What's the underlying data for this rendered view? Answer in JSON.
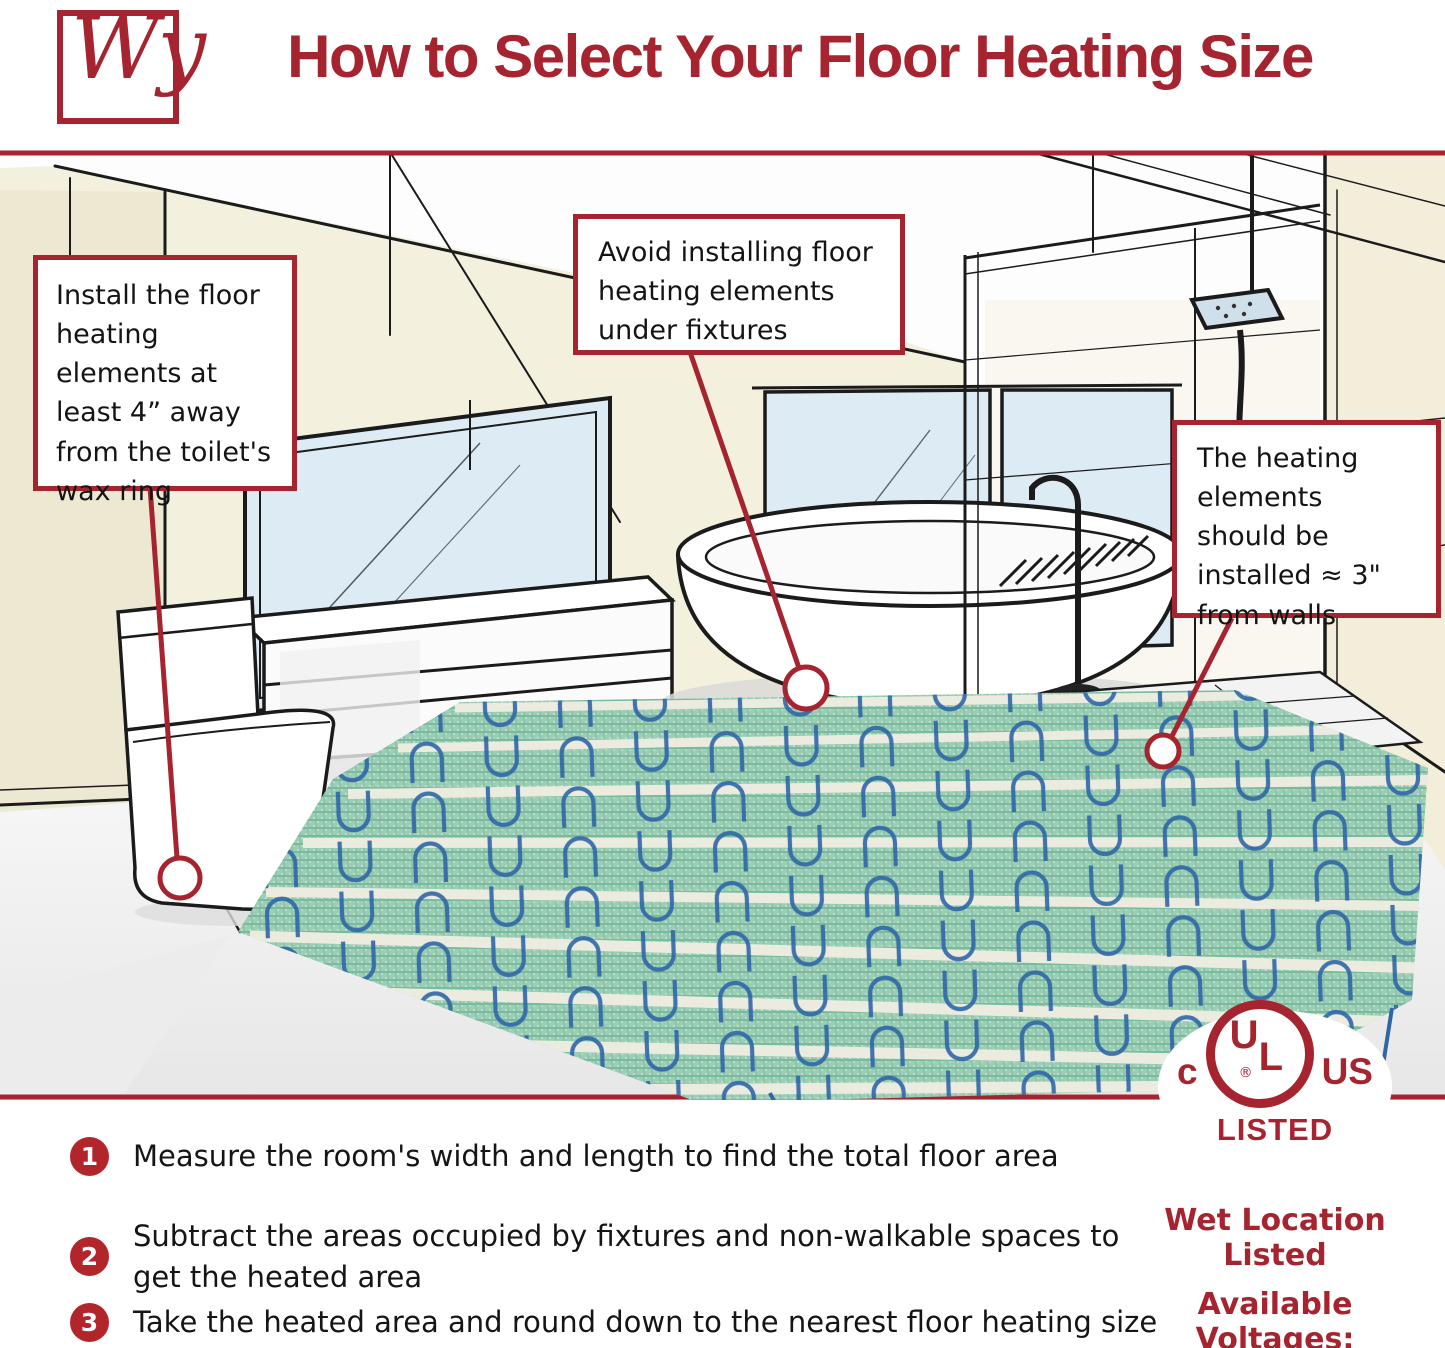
{
  "brand": {
    "logo_text": "Wy",
    "accent_color": "#A6242F"
  },
  "header": {
    "title": "How to Select Your Floor Heating Size"
  },
  "callouts": {
    "toilet": "Install the floor heating elements at least 4” away from the toilet's wax ring",
    "fixtures": "Avoid installing floor heating elements under fixtures",
    "walls": "The heating elements should be installed ≈ 3\" from walls"
  },
  "steps": [
    {
      "number": "1",
      "text": "Measure the room's width and length to find the total floor area"
    },
    {
      "number": "2",
      "text": "Subtract the areas occupied by fixtures and non-walkable spaces to\nget the heated area"
    },
    {
      "number": "3",
      "text": "Take the heated area and round down to the nearest floor heating size"
    }
  ],
  "certification": {
    "ul_c": "c",
    "ul_u": "U",
    "ul_l": "L",
    "registered": "®",
    "ul_us": "US",
    "listed": "LISTED",
    "wet_location": "Wet Location Listed",
    "voltages_label": "Available Voltages:",
    "voltages_value": "120V & 240V"
  },
  "colors": {
    "brand_red": "#A6242F",
    "step_circle_red": "#B2252B",
    "wall_beige": "#F2EEDA",
    "window_blue": "#D9EAF3",
    "mat_green": "#9CCDB5",
    "cable_blue": "#2F66A7",
    "tape_white": "#F0EEE2"
  }
}
